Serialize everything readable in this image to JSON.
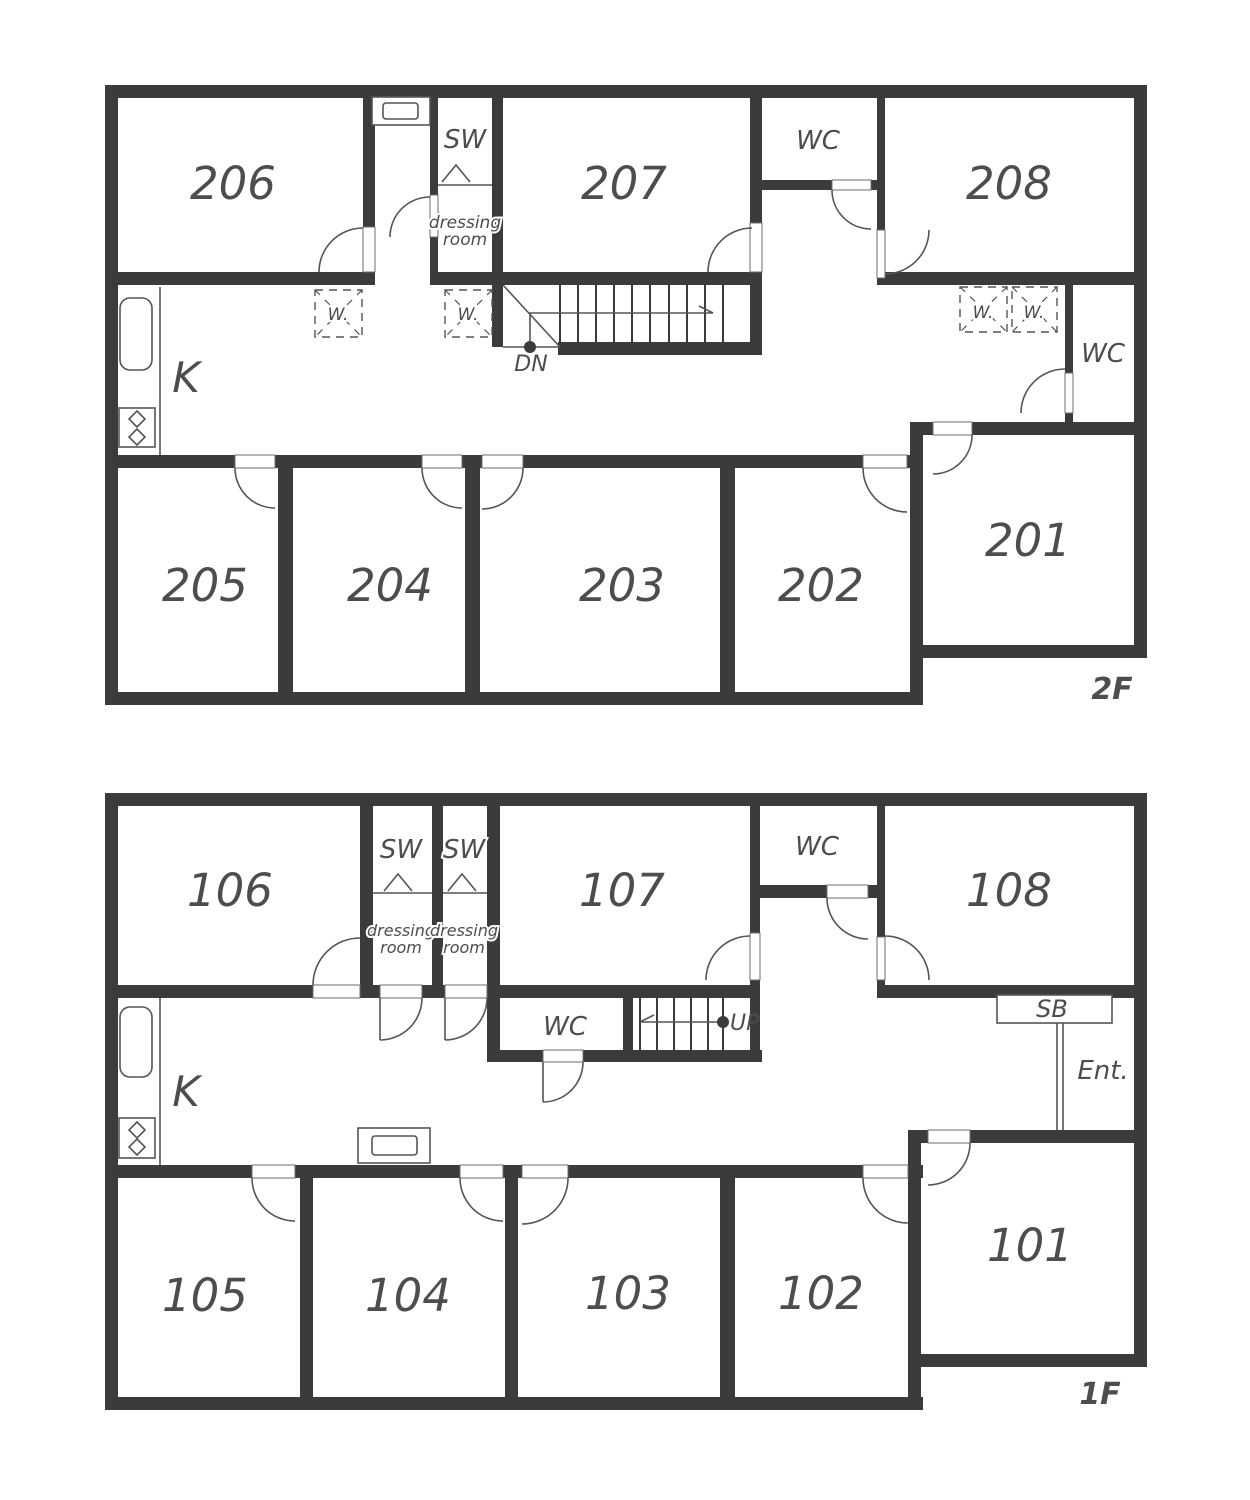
{
  "colors": {
    "wall": "#3b3b3b",
    "line": "#555555",
    "text": "#4d4d4d",
    "background": "#ffffff"
  },
  "f2": {
    "floor_label": "2F",
    "rooms": {
      "r201": "201",
      "r202": "202",
      "r203": "203",
      "r204": "204",
      "r205": "205",
      "r206": "206",
      "r207": "207",
      "r208": "208"
    },
    "kitchen_label": "K",
    "wc_top_label": "WC",
    "wc_side_label": "WC",
    "sw_label": "SW",
    "dressing_line1": "dressing",
    "dressing_line2": "room",
    "washer_label": "W.",
    "stair_label": "DN"
  },
  "f1": {
    "floor_label": "1F",
    "rooms": {
      "r101": "101",
      "r102": "102",
      "r103": "103",
      "r104": "104",
      "r105": "105",
      "r106": "106",
      "r107": "107",
      "r108": "108"
    },
    "kitchen_label": "K",
    "wc_top_label": "WC",
    "wc_mid_label": "WC",
    "sw_label": "SW",
    "dressing_line1": "dressing",
    "dressing_line2": "room",
    "stair_label": "UP",
    "shoebox_label": "SB",
    "entrance_label": "Ent."
  }
}
